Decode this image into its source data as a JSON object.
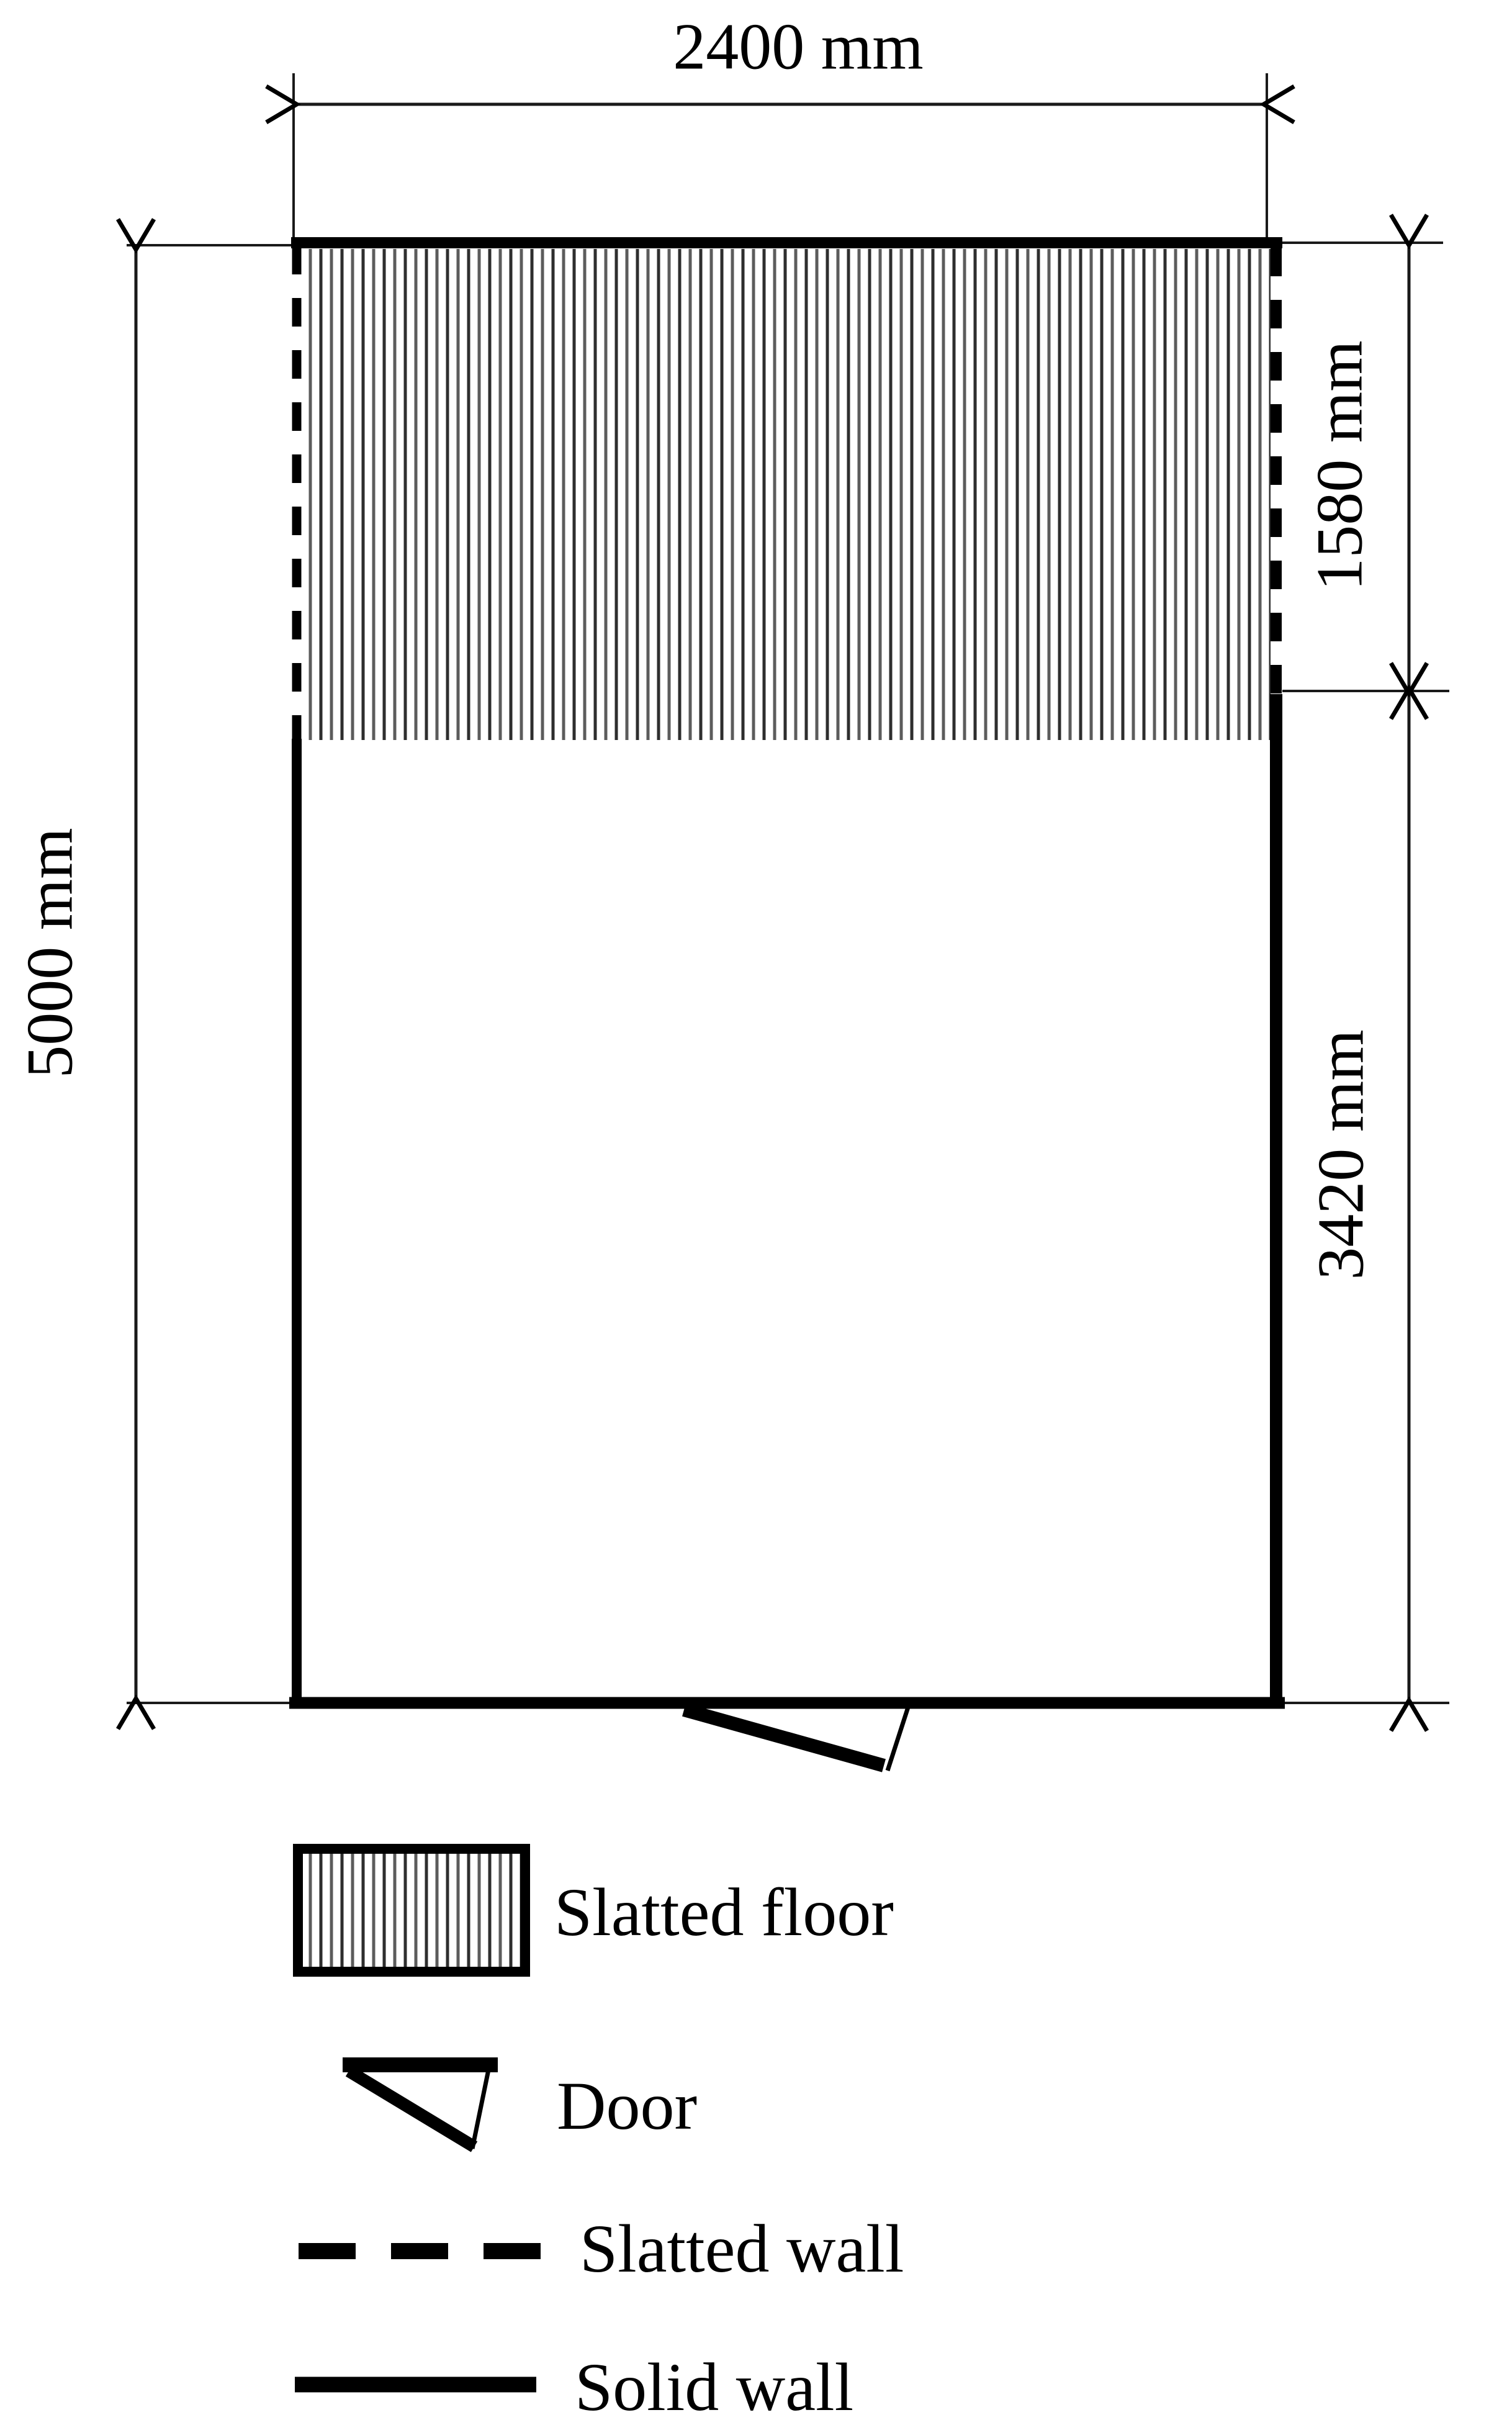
{
  "dimensions": {
    "pen_width": "2400 mm",
    "pen_length": "5000 mm",
    "slatted_section": "1580 mm",
    "solid_section": "3420 mm"
  },
  "legend": {
    "slatted_floor": "Slatted floor",
    "door": "Door",
    "slatted_wall": "Slatted wall",
    "solid_wall": "Solid wall"
  },
  "colors": {
    "ink": "#000000",
    "hatch_dark": "#2e2e2e",
    "hatch_light": "#5c5c5c",
    "background": "#ffffff"
  }
}
